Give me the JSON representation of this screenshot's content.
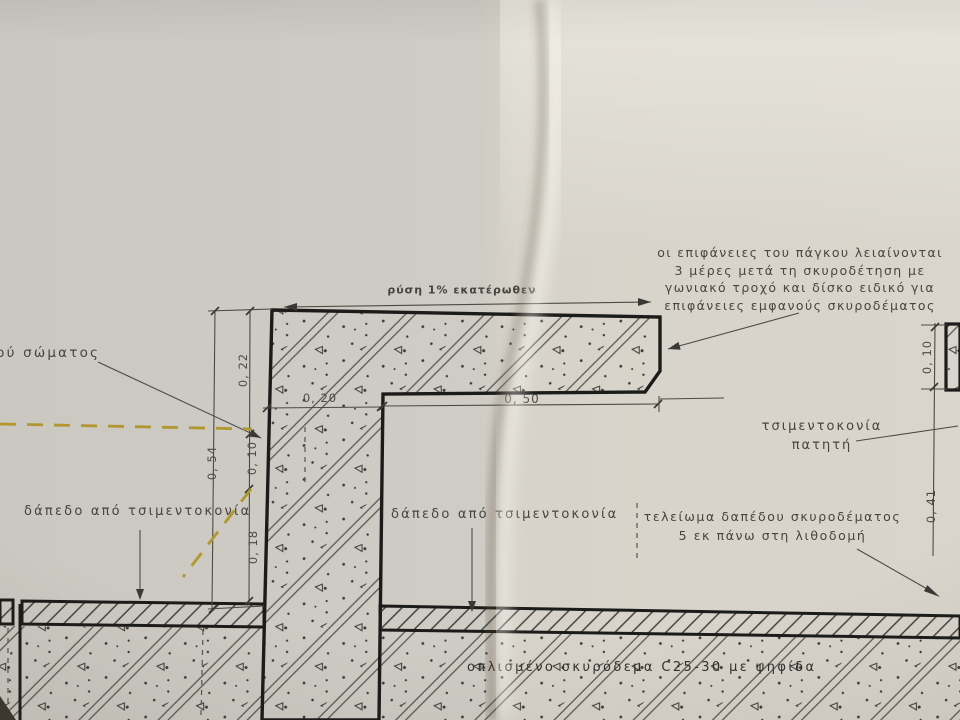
{
  "labels": {
    "slope_note": "ρύση 1% εκατέρωθεν",
    "surface_note": [
      "οι επιφάνειες του πάγκου λειαίνονται",
      "3 μέρες μετά τη σκυροδέτηση με",
      "γωνιακό τροχό και δίσκο ειδικό για",
      "επιφάνειες εμφανούς σκυροδέματος"
    ],
    "left_partial": "κού σώματος",
    "floor_left": "δάπεδο από τσιμεντοκονία",
    "floor_center": "δάπεδο από τσιμεντοκονία",
    "screed": [
      "τσιμεντοκονία",
      "πατητή"
    ],
    "floor_finish": [
      "τελείωμα δαπέδου σκυροδέματος",
      "5 εκ πάνω στη λιθοδομή"
    ],
    "concrete_note": "οπλισμένο σκυρόδεμα C25-30 με ψηφίδα"
  },
  "dimensions": {
    "slab_thickness": "0, 22",
    "total_height": "0, 54",
    "mid_height": "0, 10",
    "base_height": "0, 18",
    "wall_width": "0, 20",
    "bench_depth": "0, 50",
    "right_top": "0, 10",
    "right_height": "0, 41"
  },
  "colors": {
    "paper_left": "#cbc8c1",
    "paper_right": "#d8d4cb",
    "ink": "#1b1b19",
    "thin_line": "#4b4a45",
    "yellow_marker": "#b0972f"
  }
}
